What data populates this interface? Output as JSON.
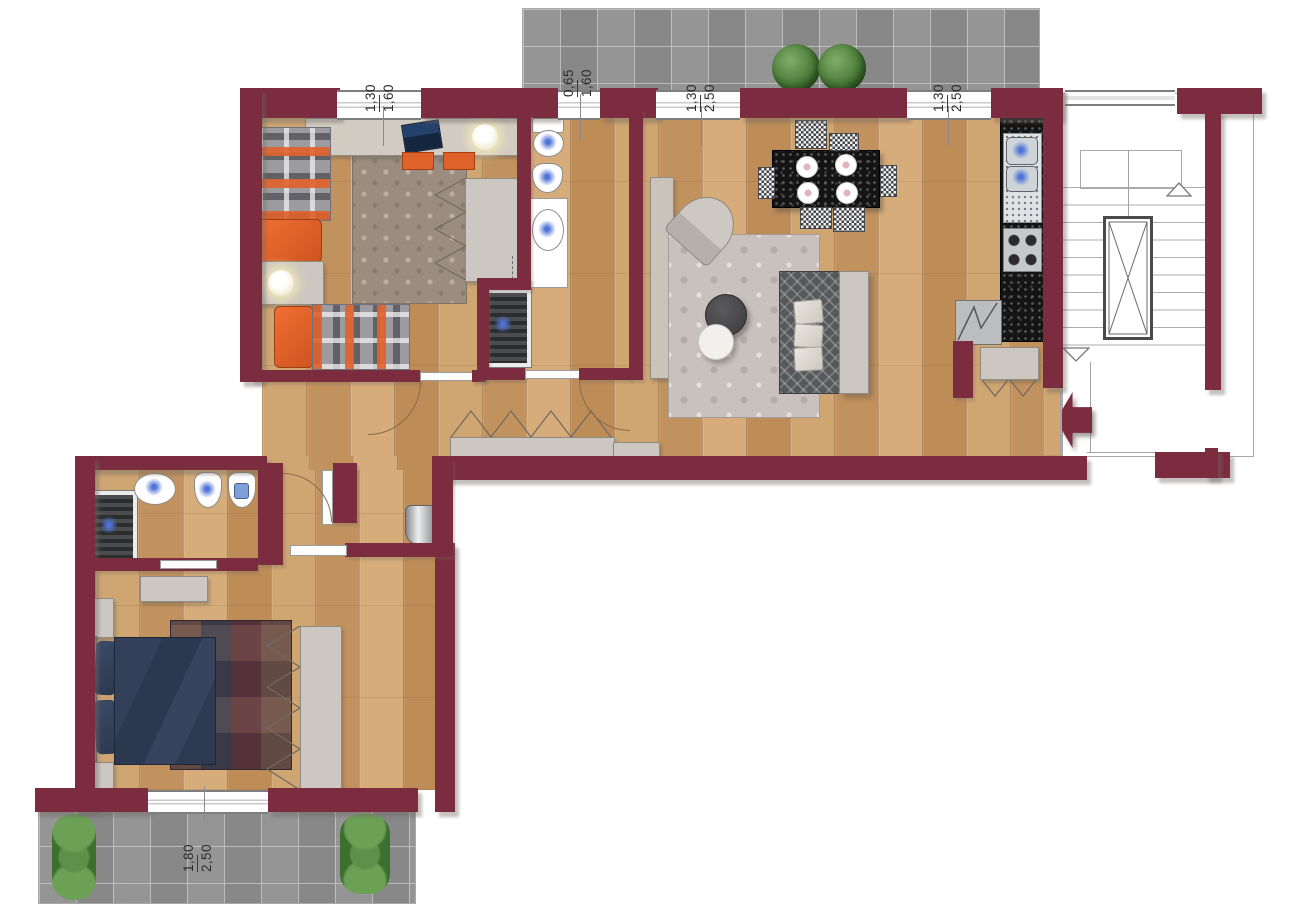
{
  "plan": {
    "type": "apartment-floor-plan",
    "rooms": [
      "terrace-top",
      "children-bedroom",
      "bathroom",
      "hallway",
      "living-dining-room",
      "kitchen",
      "stairwell-with-elevator",
      "second-bathroom",
      "master-bedroom",
      "balcony-bottom"
    ]
  },
  "dimension_labels": [
    {
      "name": "children-bedroom-window",
      "width_m": "1,30",
      "height_m": "1,60"
    },
    {
      "name": "bathroom-window",
      "width_m": "0,65",
      "height_m": "1,60"
    },
    {
      "name": "living-room-window-left",
      "width_m": "1,30",
      "height_m": "2,50"
    },
    {
      "name": "living-room-window-right",
      "width_m": "1,30",
      "height_m": "2,50"
    },
    {
      "name": "master-bedroom-window",
      "width_m": "1,80",
      "height_m": "2,50"
    }
  ],
  "colors": {
    "wall": "#7b2c3e",
    "wood_floor": "#c89a67",
    "terrace_tile": "#8f8f8f",
    "accent_orange": "#e0622b",
    "furniture_gray": "#ccc6bf",
    "bed_navy": "#2e3a4e",
    "plant_green": "#4e7f3c"
  }
}
